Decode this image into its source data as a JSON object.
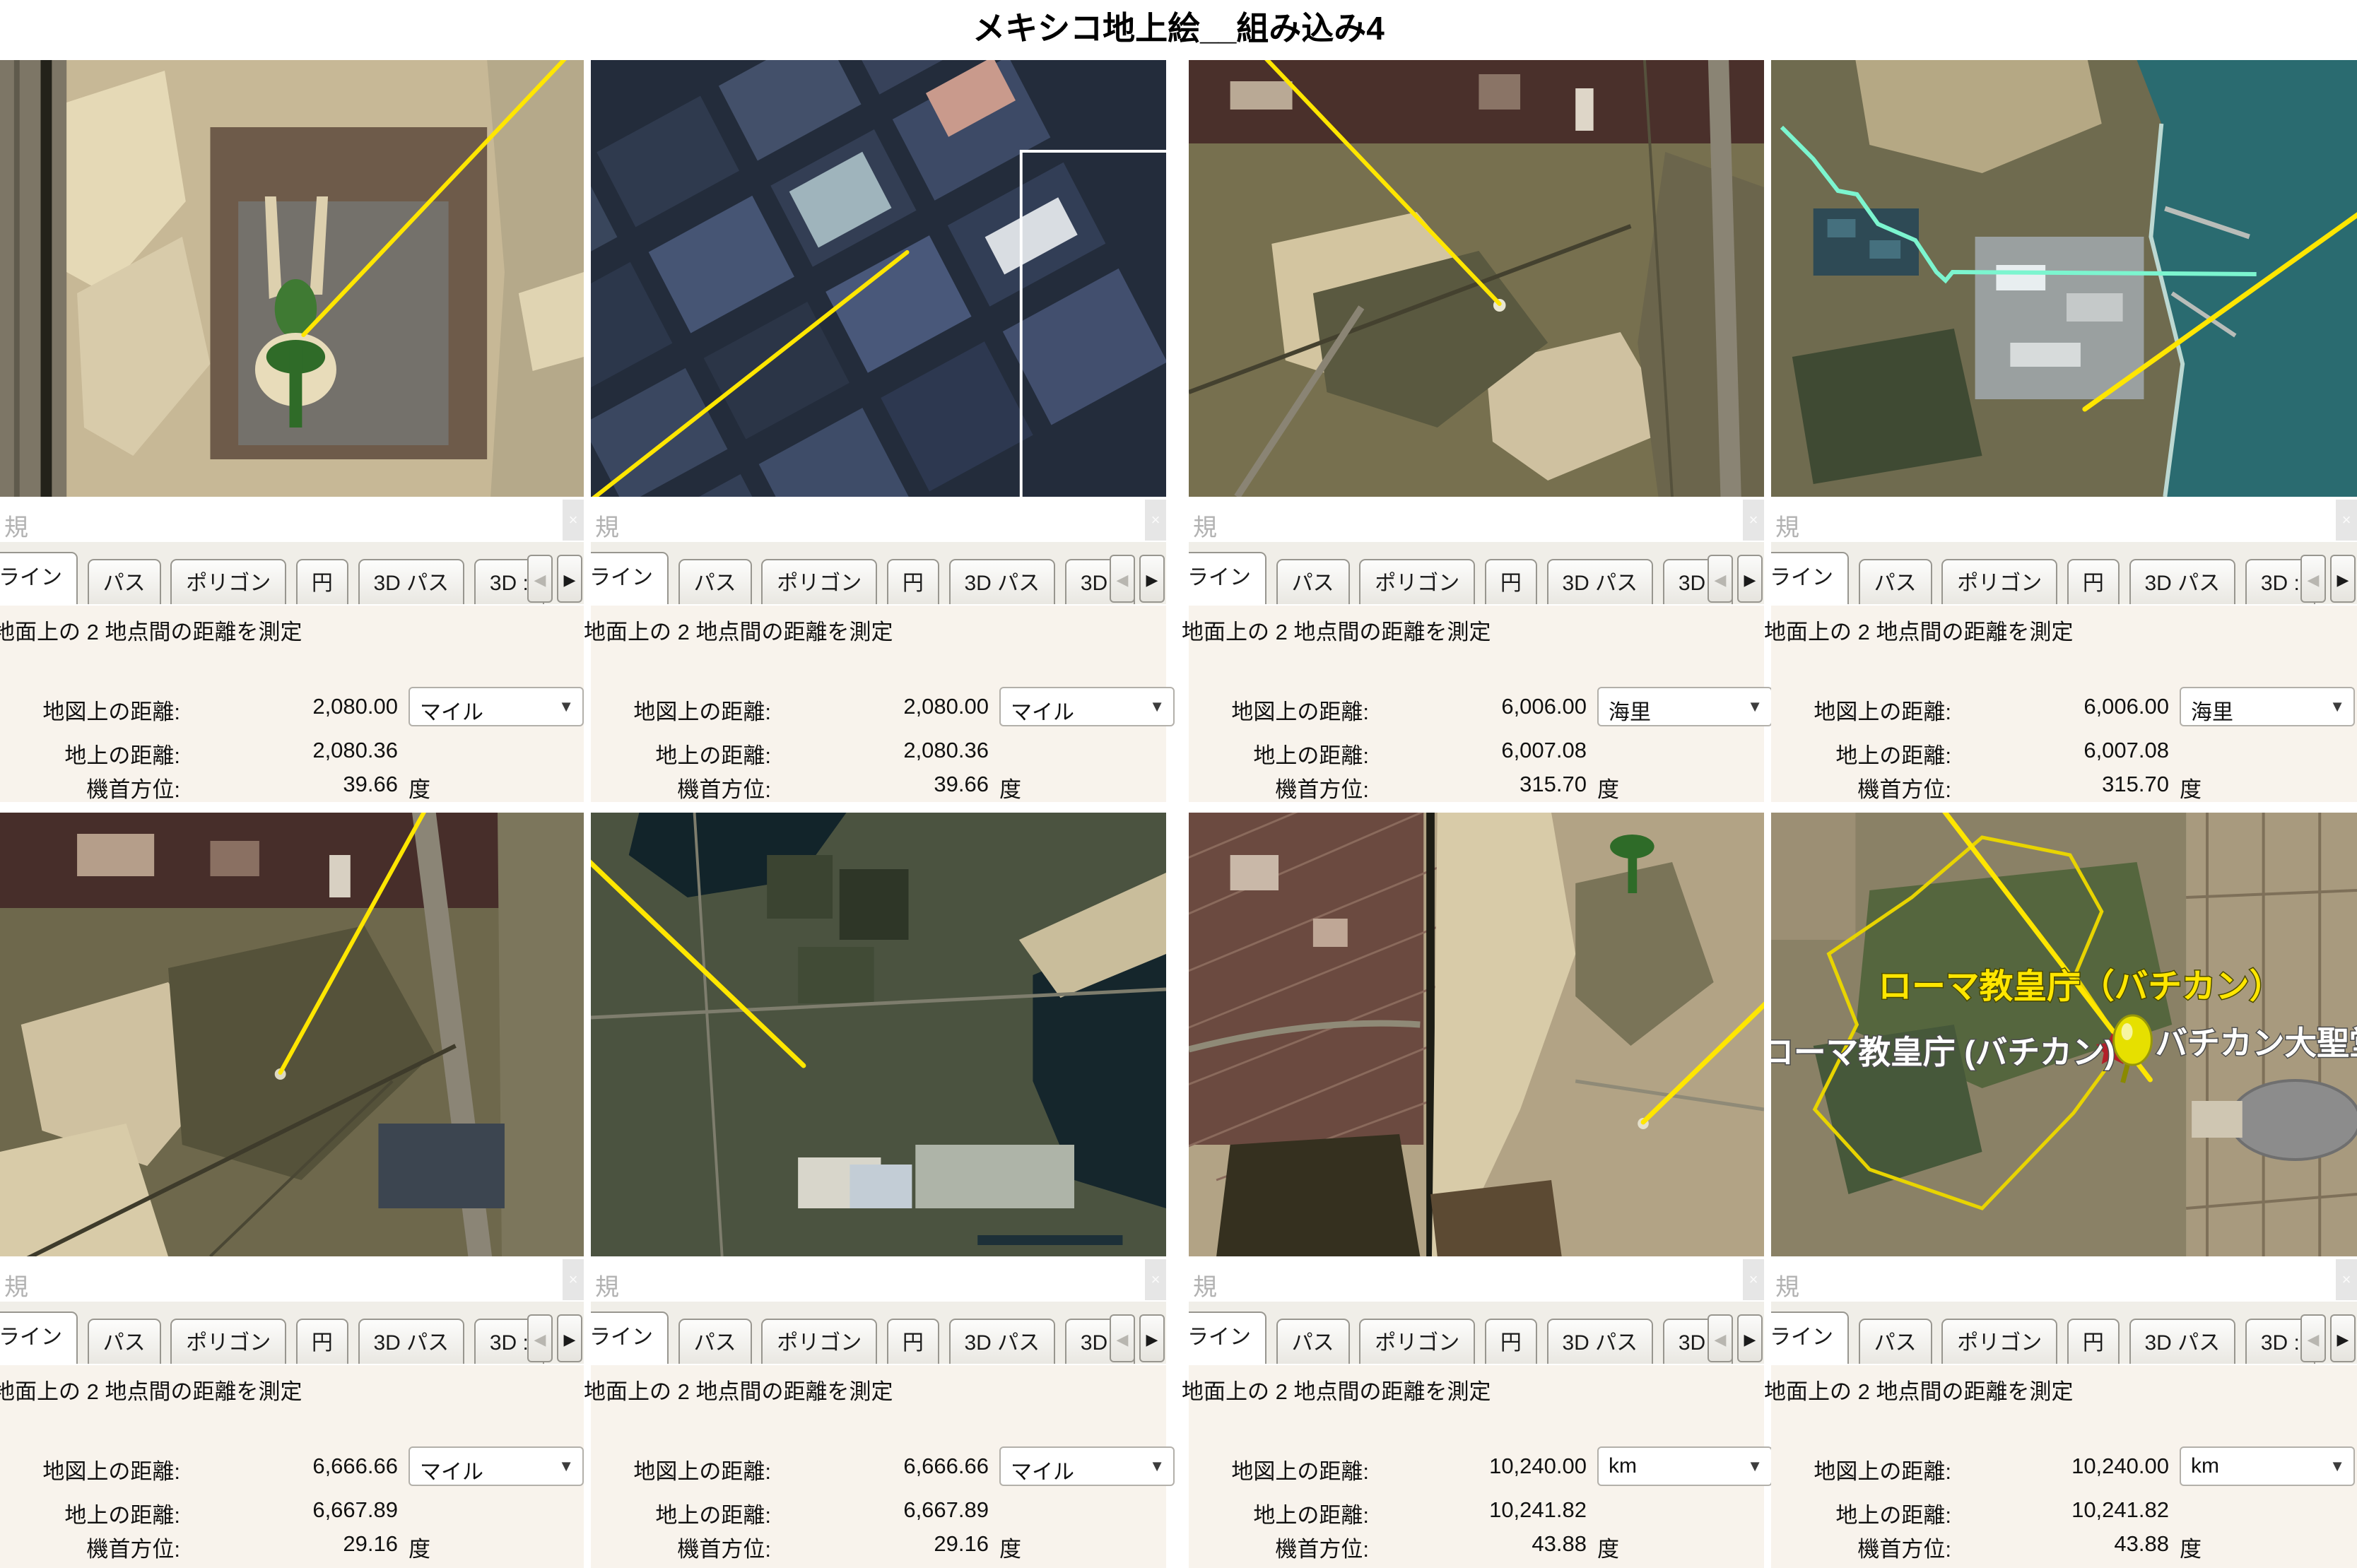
{
  "header": {
    "title": "メキシコ地上絵__組み込み4"
  },
  "icons": {
    "dropdown": "▼",
    "prev": "◀",
    "next": "▶",
    "close_fragment": "×"
  },
  "measure": {
    "window_edge_label": "規",
    "tabs": [
      "ライン",
      "パス",
      "ポリゴン",
      "円",
      "3D パス",
      "3D :"
    ],
    "description": "地面上の 2 地点間の距離を測定",
    "map_label": "地図上の距離:",
    "ground_label": "地上の距離:",
    "heading_label": "機首方位:",
    "deg": "度"
  },
  "panels": [
    {
      "map": "2,080.00",
      "unit": "マイル",
      "ground": "2,080.36",
      "heading": "39.66"
    },
    {
      "map": "2,080.00",
      "unit": "マイル",
      "ground": "2,080.36",
      "heading": "39.66"
    },
    {
      "map": "6,006.00",
      "unit": "海里",
      "ground": "6,007.08",
      "heading": "315.70"
    },
    {
      "map": "6,006.00",
      "unit": "海里",
      "ground": "6,007.08",
      "heading": "315.70"
    },
    {
      "map": "6,666.66",
      "unit": "マイル",
      "ground": "6,667.89",
      "heading": "29.16"
    },
    {
      "map": "6,666.66",
      "unit": "マイル",
      "ground": "6,667.89",
      "heading": "29.16"
    },
    {
      "map": "10,240.00",
      "unit": "km",
      "ground": "10,241.82",
      "heading": "43.88"
    },
    {
      "map": "10,240.00",
      "unit": "km",
      "ground": "10,241.82",
      "heading": "43.88"
    }
  ],
  "vatican": {
    "label_top": "ローマ教皇庁（バチカン）",
    "label_left": "ローマ教皇庁 (バチカン)",
    "label_right": "バチカン大聖堂"
  },
  "colors": {
    "measure_line": "#ffe600",
    "gps_track": "#7cf5cf",
    "panel_bg": "#f8f3ec",
    "sea": "#2a6b70"
  }
}
